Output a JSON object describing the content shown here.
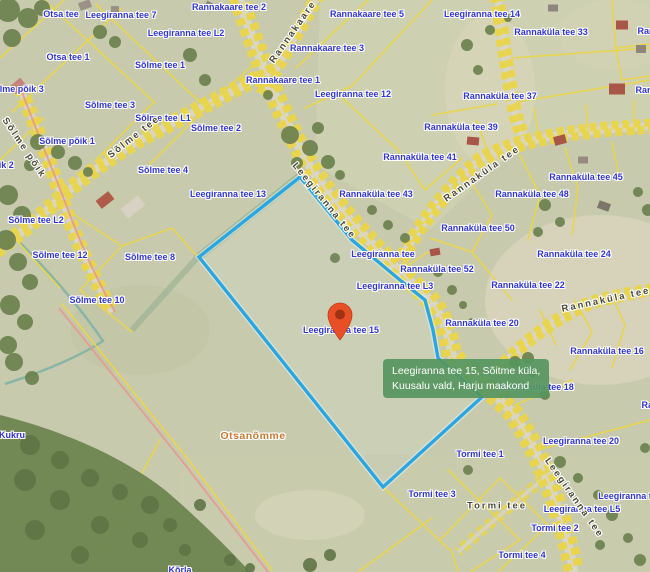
{
  "map": {
    "tooltip": {
      "line1": "Leegiranna tee 15, Sõitme küla,",
      "line2": "Kuusalu vald, Harju maakond"
    },
    "marker": {
      "name": "location-pin",
      "x": 340,
      "y": 340,
      "color": "#e94f26",
      "inner_color": "#9e3216"
    },
    "selected_parcel": {
      "label": "Leegiranna tee 15",
      "outline_points": "199,257 300,177 352,240 400,280 425,300 433,330 438,358 482,397 383,487",
      "outline_color": "#2aa7e2"
    },
    "colors": {
      "parcel_label": "#3136cf",
      "road_label": "#4a4a38",
      "place_label": "#c57a36",
      "boundary_yellow": "#e9d54d",
      "boundary_pink": "#e59a94",
      "selected_outline": "#2aa7e2",
      "ditch_teal": "#82b3a6",
      "road_fill": "#d9d6c6",
      "field_base": "#c7caac",
      "forest_green": "#6a7f4c",
      "tooltip_bg": "rgba(86,150,96,0.92)"
    },
    "labels": [
      {
        "t": "Otsa tee",
        "x": 61,
        "y": 14,
        "k": "p"
      },
      {
        "t": "Leegiranna tee 7",
        "x": 121,
        "y": 15,
        "k": "p"
      },
      {
        "t": "Rannakaare tee 2",
        "x": 229,
        "y": 7,
        "k": "p"
      },
      {
        "t": "Leegiranna tee L2",
        "x": 186,
        "y": 33,
        "k": "p"
      },
      {
        "t": "Rannakaare tee 5",
        "x": 367,
        "y": 14,
        "k": "p"
      },
      {
        "t": "Leegiranna tee 14",
        "x": 482,
        "y": 14,
        "k": "p"
      },
      {
        "t": "Rannaküla tee 33",
        "x": 551,
        "y": 32,
        "k": "p"
      },
      {
        "t": "Rannaküla tee",
        "x": 668,
        "y": 31,
        "k": "p"
      },
      {
        "t": "Otsa tee 1",
        "x": 68,
        "y": 57,
        "k": "p"
      },
      {
        "t": "Sõlme tee 1",
        "x": 160,
        "y": 65,
        "k": "p"
      },
      {
        "t": "Rannakaare tee 3",
        "x": 327,
        "y": 48,
        "k": "p"
      },
      {
        "t": "Rannakaare tee 1",
        "x": 283,
        "y": 80,
        "k": "p"
      },
      {
        "t": "Leegiranna tee 12",
        "x": 353,
        "y": 94,
        "k": "p"
      },
      {
        "t": "Rannaküla tee 37",
        "x": 500,
        "y": 96,
        "k": "p"
      },
      {
        "t": "Rannaküla tee",
        "x": 666,
        "y": 90,
        "k": "p"
      },
      {
        "t": "Sõlme põik 3",
        "x": 16,
        "y": 89,
        "k": "p"
      },
      {
        "t": "Sõlme tee 3",
        "x": 110,
        "y": 105,
        "k": "p"
      },
      {
        "t": "Sõlme tee L1",
        "x": 163,
        "y": 118,
        "k": "p"
      },
      {
        "t": "Sõlme tee 2",
        "x": 216,
        "y": 128,
        "k": "p"
      },
      {
        "t": "Sõlme põik 1",
        "x": 67,
        "y": 141,
        "k": "p"
      },
      {
        "t": "Sõlme põik 2",
        "x": -14,
        "y": 165,
        "k": "p"
      },
      {
        "t": "Sõlme tee 4",
        "x": 163,
        "y": 170,
        "k": "p"
      },
      {
        "t": "Rannaküla tee 39",
        "x": 461,
        "y": 127,
        "k": "p"
      },
      {
        "t": "Rannaküla tee 41",
        "x": 420,
        "y": 157,
        "k": "p"
      },
      {
        "t": "Rannaküla tee 45",
        "x": 586,
        "y": 177,
        "k": "p"
      },
      {
        "t": "Leegiranna tee 13",
        "x": 228,
        "y": 194,
        "k": "p"
      },
      {
        "t": "Rannaküla tee 43",
        "x": 376,
        "y": 194,
        "k": "p"
      },
      {
        "t": "Rannaküla tee 48",
        "x": 532,
        "y": 194,
        "k": "p"
      },
      {
        "t": "Sõlme tee L2",
        "x": 36,
        "y": 220,
        "k": "p"
      },
      {
        "t": "Rannaküla tee 50",
        "x": 478,
        "y": 228,
        "k": "p"
      },
      {
        "t": "Leegiranna tee",
        "x": 383,
        "y": 254,
        "k": "p"
      },
      {
        "t": "Rannaküla tee 24",
        "x": 574,
        "y": 254,
        "k": "p"
      },
      {
        "t": "Sõlme tee 12",
        "x": 60,
        "y": 255,
        "k": "p"
      },
      {
        "t": "Sõlme tee 8",
        "x": 150,
        "y": 257,
        "k": "p"
      },
      {
        "t": "Rannaküla tee 52",
        "x": 437,
        "y": 269,
        "k": "p"
      },
      {
        "t": "Rannaküla tee 22",
        "x": 528,
        "y": 285,
        "k": "p"
      },
      {
        "t": "Leegiranna tee L3",
        "x": 395,
        "y": 286,
        "k": "p"
      },
      {
        "t": "Sõlme tee 10",
        "x": 97,
        "y": 300,
        "k": "p"
      },
      {
        "t": "Rannaküla tee 20",
        "x": 482,
        "y": 323,
        "k": "p"
      },
      {
        "t": "Leegiranna tee 15",
        "x": 341,
        "y": 330,
        "k": "p"
      },
      {
        "t": "Rannaküla tee 16",
        "x": 607,
        "y": 351,
        "k": "p"
      },
      {
        "t": "Rannaküla tee 18",
        "x": 537,
        "y": 387,
        "k": "p"
      },
      {
        "t": "Rannaküla tee",
        "x": 672,
        "y": 405,
        "k": "p"
      },
      {
        "t": "Kukru",
        "x": 12,
        "y": 435,
        "k": "p"
      },
      {
        "t": "Leegiranna tee 20",
        "x": 581,
        "y": 441,
        "k": "p"
      },
      {
        "t": "Tormi tee 1",
        "x": 480,
        "y": 454,
        "k": "p"
      },
      {
        "t": "Tormi tee 3",
        "x": 432,
        "y": 494,
        "k": "p"
      },
      {
        "t": "Leegiranna tee",
        "x": 630,
        "y": 496,
        "k": "p"
      },
      {
        "t": "Leegiranna tee L5",
        "x": 582,
        "y": 509,
        "k": "p"
      },
      {
        "t": "Tormi tee 2",
        "x": 555,
        "y": 528,
        "k": "p"
      },
      {
        "t": "Tormi tee 4",
        "x": 522,
        "y": 555,
        "k": "p"
      },
      {
        "t": "Rannaküla tee",
        "x": 684,
        "y": 555,
        "k": "p"
      },
      {
        "t": "Kõrla",
        "x": 180,
        "y": 570,
        "k": "p"
      },
      {
        "t": "Sõlme põik",
        "x": 24,
        "y": 148,
        "k": "r",
        "r": 56
      },
      {
        "t": "Sõlme tee",
        "x": 134,
        "y": 137,
        "k": "r",
        "r": -38
      },
      {
        "t": "Rannakaare tee",
        "x": 300,
        "y": 22,
        "k": "r",
        "r": -55
      },
      {
        "t": "Leegiranna tee",
        "x": 324,
        "y": 201,
        "k": "r",
        "r": 51
      },
      {
        "t": "Rannaküla tee",
        "x": 482,
        "y": 174,
        "k": "r",
        "r": -35
      },
      {
        "t": "Rannaküla tee",
        "x": 606,
        "y": 300,
        "k": "r",
        "r": -12
      },
      {
        "t": "Leegiranna tee",
        "x": 574,
        "y": 498,
        "k": "r",
        "r": 55
      },
      {
        "t": "Tormi tee",
        "x": 497,
        "y": 506,
        "k": "r",
        "r": 0
      },
      {
        "t": "Otsanõmme",
        "x": 253,
        "y": 436,
        "k": "o"
      }
    ]
  }
}
